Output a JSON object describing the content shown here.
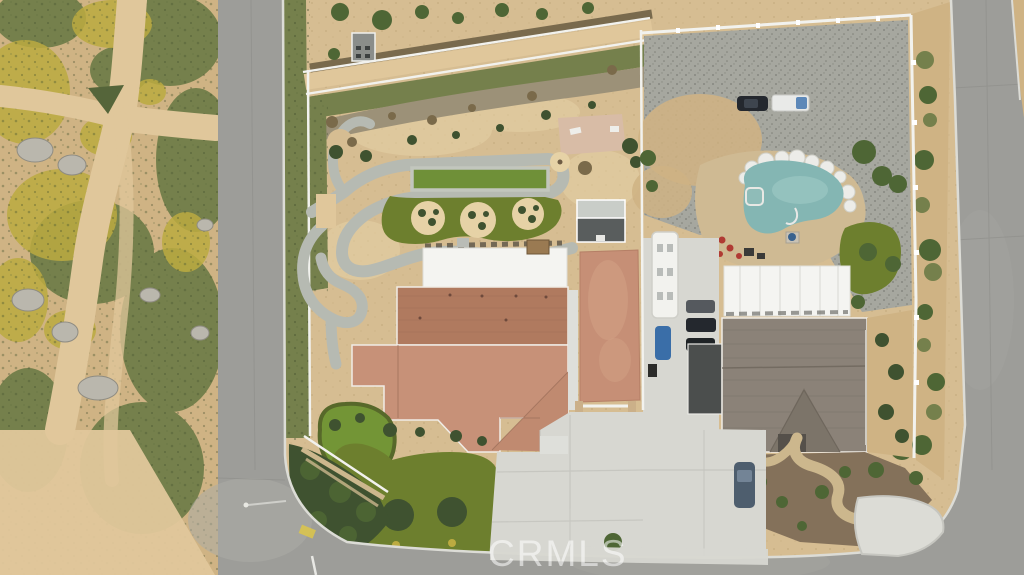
{
  "watermark": {
    "text": "CRMLS"
  },
  "scene": {
    "type": "aerial-photo",
    "features": [
      "vacant-dirt-lot-with-wildflowers-and-boulders",
      "residential-street-left",
      "residential-street-bottom",
      "residential-street-right",
      "landscaped-backyard-with-bocce-court",
      "putting-green",
      "front-lawn-with-trees",
      "tile-roof-house",
      "rv-concrete-pad",
      "neighbor-swimming-pool-with-spa",
      "gravel-yard-with-parked-truck-and-car",
      "parked-rv",
      "workshop-white-roof",
      "neighbor-shingle-roof-house",
      "curved-front-path",
      "driveways-with-parked-cars"
    ]
  },
  "palette": {
    "asphalt": "#9d9d99",
    "asphalt-light": "#acaca6",
    "curb": "#dcdcd6",
    "dirt": "#cfb384",
    "dirt-road": "#e0c79b",
    "scrub": "#75804c",
    "scrub-dark": "#55653a",
    "wildflower": "#bcab41",
    "boulder": "#bab7ad",
    "dg": "#d6bd92",
    "dg-light": "#e6d2a6",
    "mulch-dark": "#6f6046",
    "rock-band": "#9c9178",
    "path-gray": "#b6bab2",
    "court": "#6f9038",
    "turf": "#6d7f2e",
    "turf-dark": "#57682a",
    "green-bright": "#739536",
    "bush": "#3f5230",
    "tree": "#4e6635",
    "concrete": "#d7d7d1",
    "pad-red": "#c68f76",
    "roof-terra": "#b07a5f",
    "roof-salmon": "#c79178",
    "roof-gray": "#8b8278",
    "roof-gray-dark": "#7c7469",
    "white-roof": "#f4f4f1",
    "gravel": "#a6a79f",
    "deck": "#cfba93",
    "pool": "#84b6b3",
    "pool-light": "#a8d0cb",
    "spa": "#8fbcb8",
    "firepit-blue": "#39628e",
    "mulch": "#84715a",
    "path-tan": "#ccb78d",
    "red-accent": "#b03a33",
    "car-dark": "#24282e",
    "car-blue": "#3a6ea8",
    "truck-blue": "#5d88b8",
    "fence-white": "#f2f2ee"
  }
}
